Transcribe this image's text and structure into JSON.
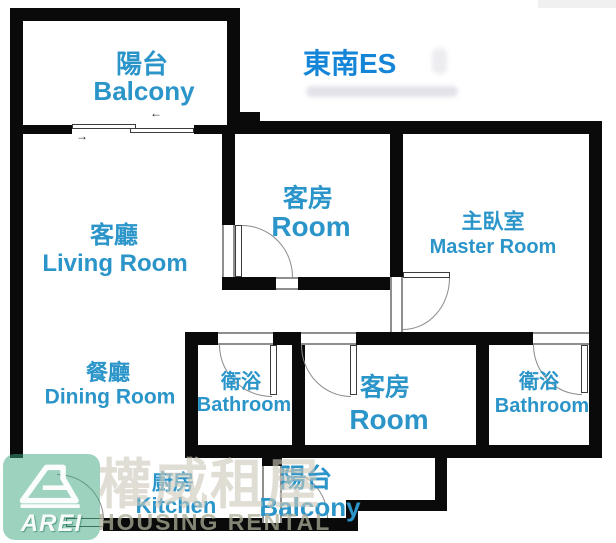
{
  "compass": {
    "text": "東南ES"
  },
  "rooms": {
    "balcony_top": {
      "zh": "陽台",
      "en": "Balcony"
    },
    "living": {
      "zh": "客廳",
      "en": "Living Room"
    },
    "guest1": {
      "zh": "客房",
      "en": "Room"
    },
    "master": {
      "zh": "主臥室",
      "en": "Master Room"
    },
    "dining": {
      "zh": "餐廳",
      "en": "Dining Room"
    },
    "bath1": {
      "zh": "衛浴",
      "en": "Bathroom"
    },
    "guest2": {
      "zh": "客房",
      "en": "Room"
    },
    "bath2": {
      "zh": "衛浴",
      "en": "Bathroom"
    },
    "kitchen": {
      "zh": "廚房",
      "en": "Kitchen"
    },
    "balcony_bottom": {
      "zh": "陽台",
      "en": "Balcony"
    }
  },
  "watermark": {
    "logo_text": "AREI",
    "brand_zh": "權威租屋",
    "brand_en": "HOUSING RENTAL"
  },
  "colors": {
    "room_label": "#2b95c9",
    "compass_text": "#1585d8",
    "wall": "#0a0a0a",
    "watermark_green": "rgba(60,165,125,0.5)",
    "watermark_gray": "rgba(205,200,186,0.62)"
  }
}
